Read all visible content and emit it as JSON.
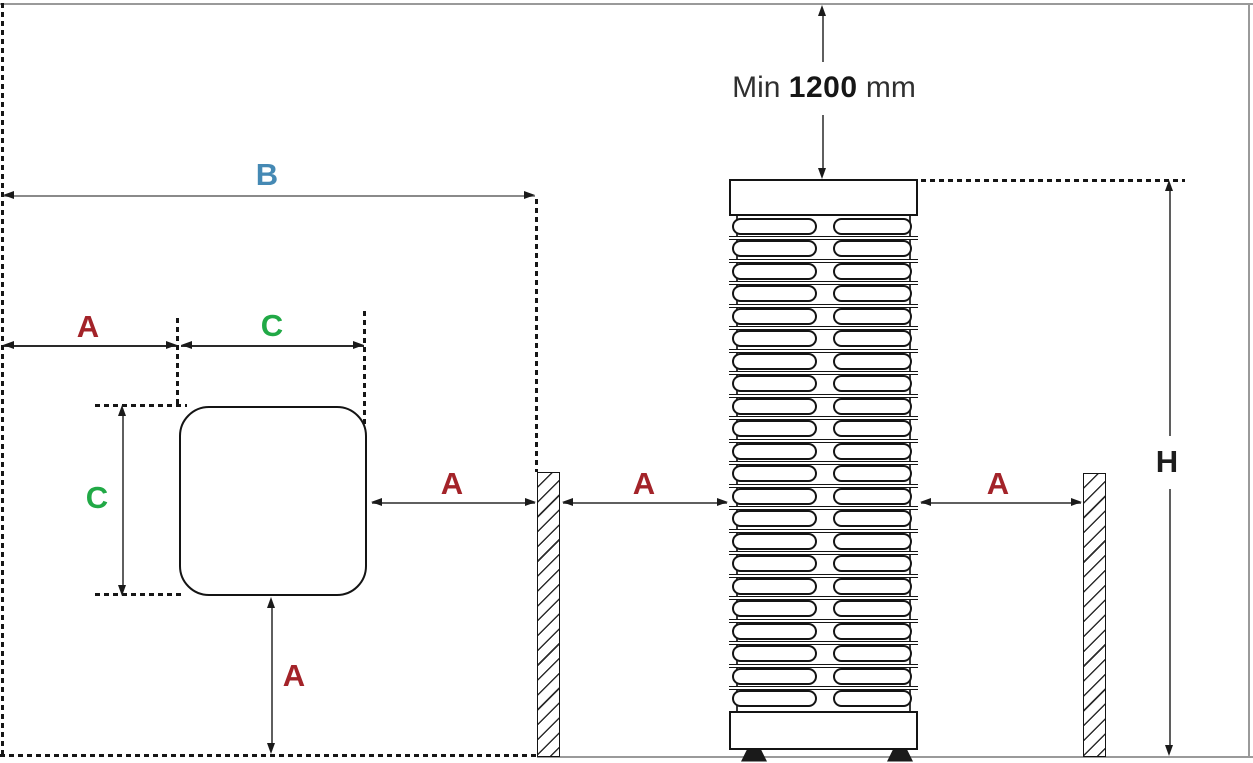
{
  "note": {
    "prefix": "Min",
    "value": "1200",
    "unit": "mm"
  },
  "labels": {
    "a": "A",
    "b": "B",
    "c": "C",
    "h": "H"
  },
  "colors": {
    "label_a_red": "#a32329",
    "label_b_blue": "#4589b4",
    "label_c_green": "#21a946",
    "label_h_black": "#1d1d1d",
    "dimension_line_gray": "#5f5f5f",
    "boundary_gray": "#9a9a9a",
    "drawing_black": "#141414"
  },
  "heater": {
    "rows": 22,
    "columns": 2
  }
}
